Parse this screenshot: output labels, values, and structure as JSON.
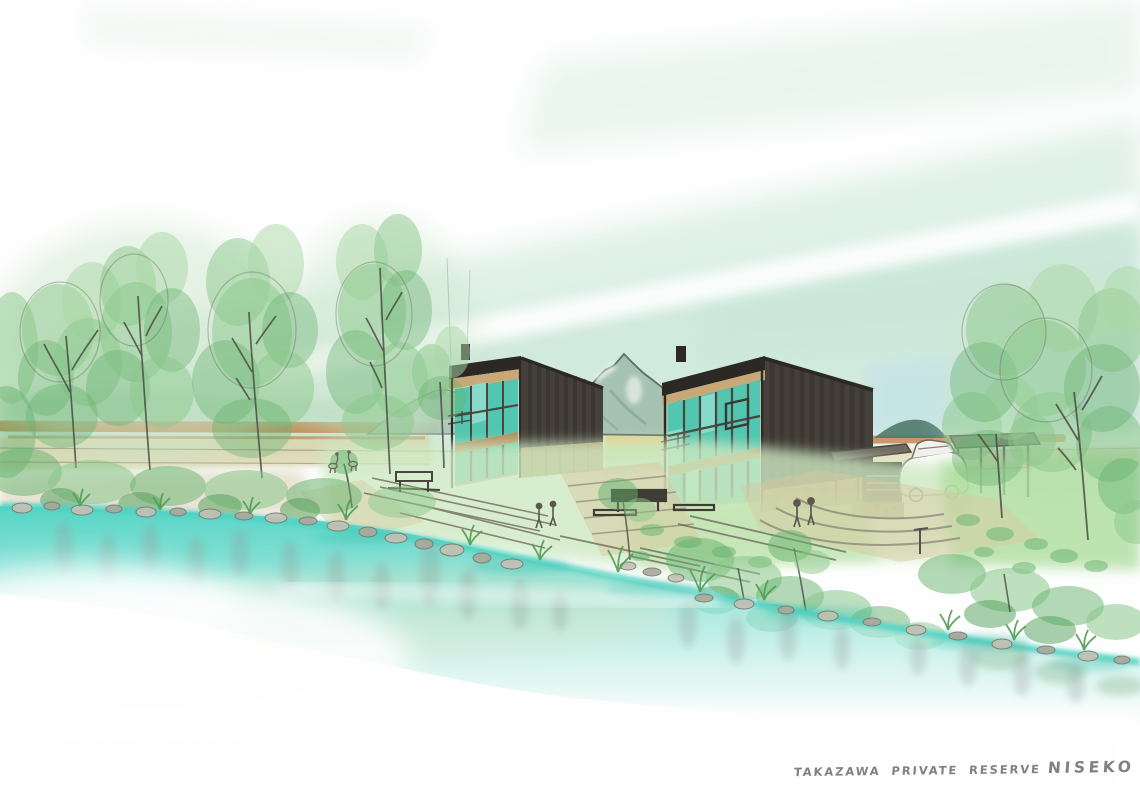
{
  "caption": {
    "title": "TAKAZAWA PRIVATE RESERVE",
    "location": "NISEKO"
  },
  "palette": {
    "paper": "#fefefe",
    "sky-mint": "#d9eee3",
    "sky-mint-deep": "#cde8db",
    "sky-mint-top": "#e2f2e9",
    "sky-blue": "#c6e3e7",
    "mountain": "#a6c3b1",
    "mountain-line": "#5c7164",
    "hill-dark": "#4e7a6a",
    "field-orange": "#c27b3e",
    "field-khaki": "#dcc98f",
    "field-yellow": "#e6cc7f",
    "cabin-dark": "#45403a",
    "cabin-darker": "#2c2925",
    "wood": "#b18f60",
    "wood-light": "#c7a876",
    "glass": "#52c6b0",
    "glass-light": "#8eddcd",
    "mullion": "#4a463f",
    "pencil": "#5c5c55",
    "stone": "#c4c0b4",
    "stone-dark": "#aba79b",
    "stone-line": "#7b776b",
    "grass-wash": "#cfe9c3",
    "grass-mid": "#aedd9f",
    "leaf": "#8bc78b",
    "leaf-pale": "#a9d8a5",
    "leaf-dark": "#66b26e",
    "leaf-deep": "#4f9e55",
    "path-tan": "#d9c7a0",
    "water-strong": "#4ed3c4",
    "water-mid": "#7fdfd2",
    "water-pale": "#c8f0e9",
    "reflect-gray": "#939c94",
    "reflect-teal": "#3cbfae",
    "metal-gray": "#85817a",
    "caption-ink": "#6b6d66"
  }
}
